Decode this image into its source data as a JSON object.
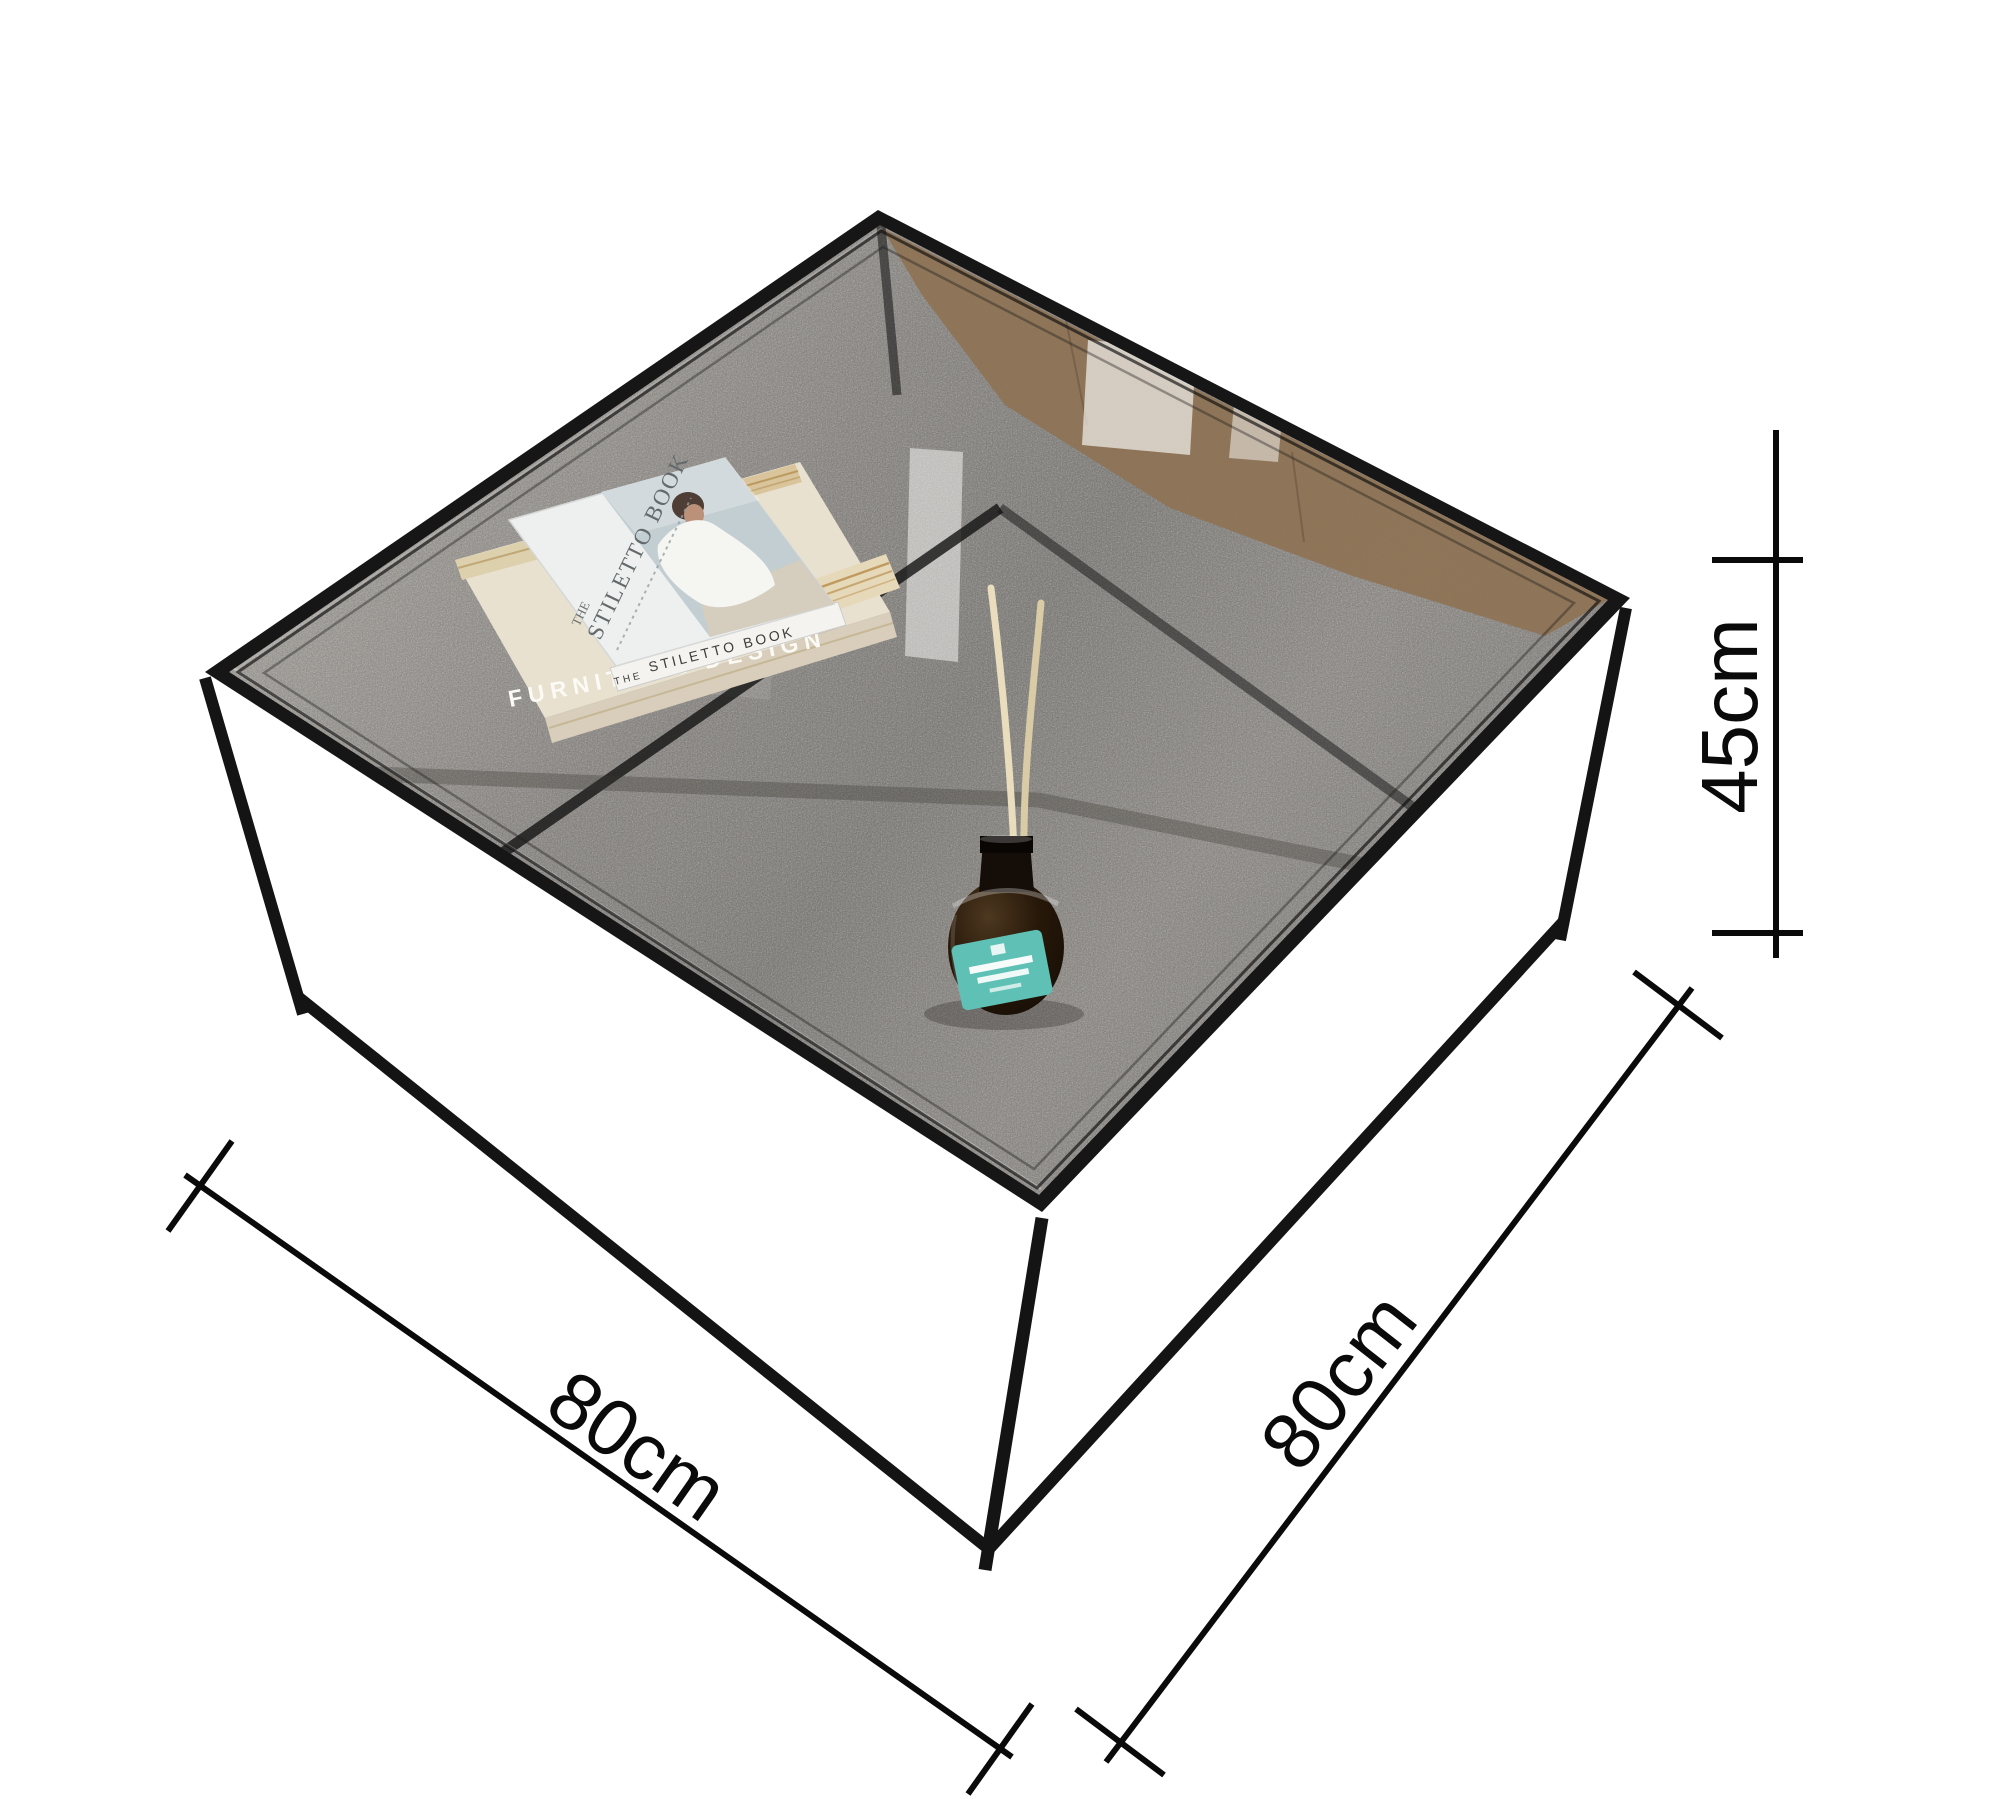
{
  "scene": {
    "description": "Product dimension photo of a square glass-top coffee table with black metal cube frame standing on gray carpet, shot from above-front, cut out on white",
    "background_color": "#ffffff"
  },
  "dimensions": {
    "width": {
      "label": "80cm"
    },
    "depth": {
      "label": "80cm"
    },
    "height": {
      "label": "45cm"
    }
  },
  "table": {
    "frame_color": "#161616",
    "glass_carpet_color": "#8a8784",
    "wood_floor_color": "#8e7355"
  },
  "props": {
    "books": {
      "top": {
        "title_prefix": "THE",
        "title": "STILETTO BOOK",
        "spine_prefix": "THE",
        "spine_title": "STILETTO BOOK",
        "cover_color": "#edf0ef",
        "photo_color": "#c3ced2"
      },
      "bottom": {
        "title": "FURNITURE DESIGN",
        "cover_color": "#e8e1cf"
      }
    },
    "diffuser": {
      "bottle_color": "#1d1208",
      "label_color": "#5fc0b5",
      "reed_color": "#e9ddbd"
    }
  }
}
